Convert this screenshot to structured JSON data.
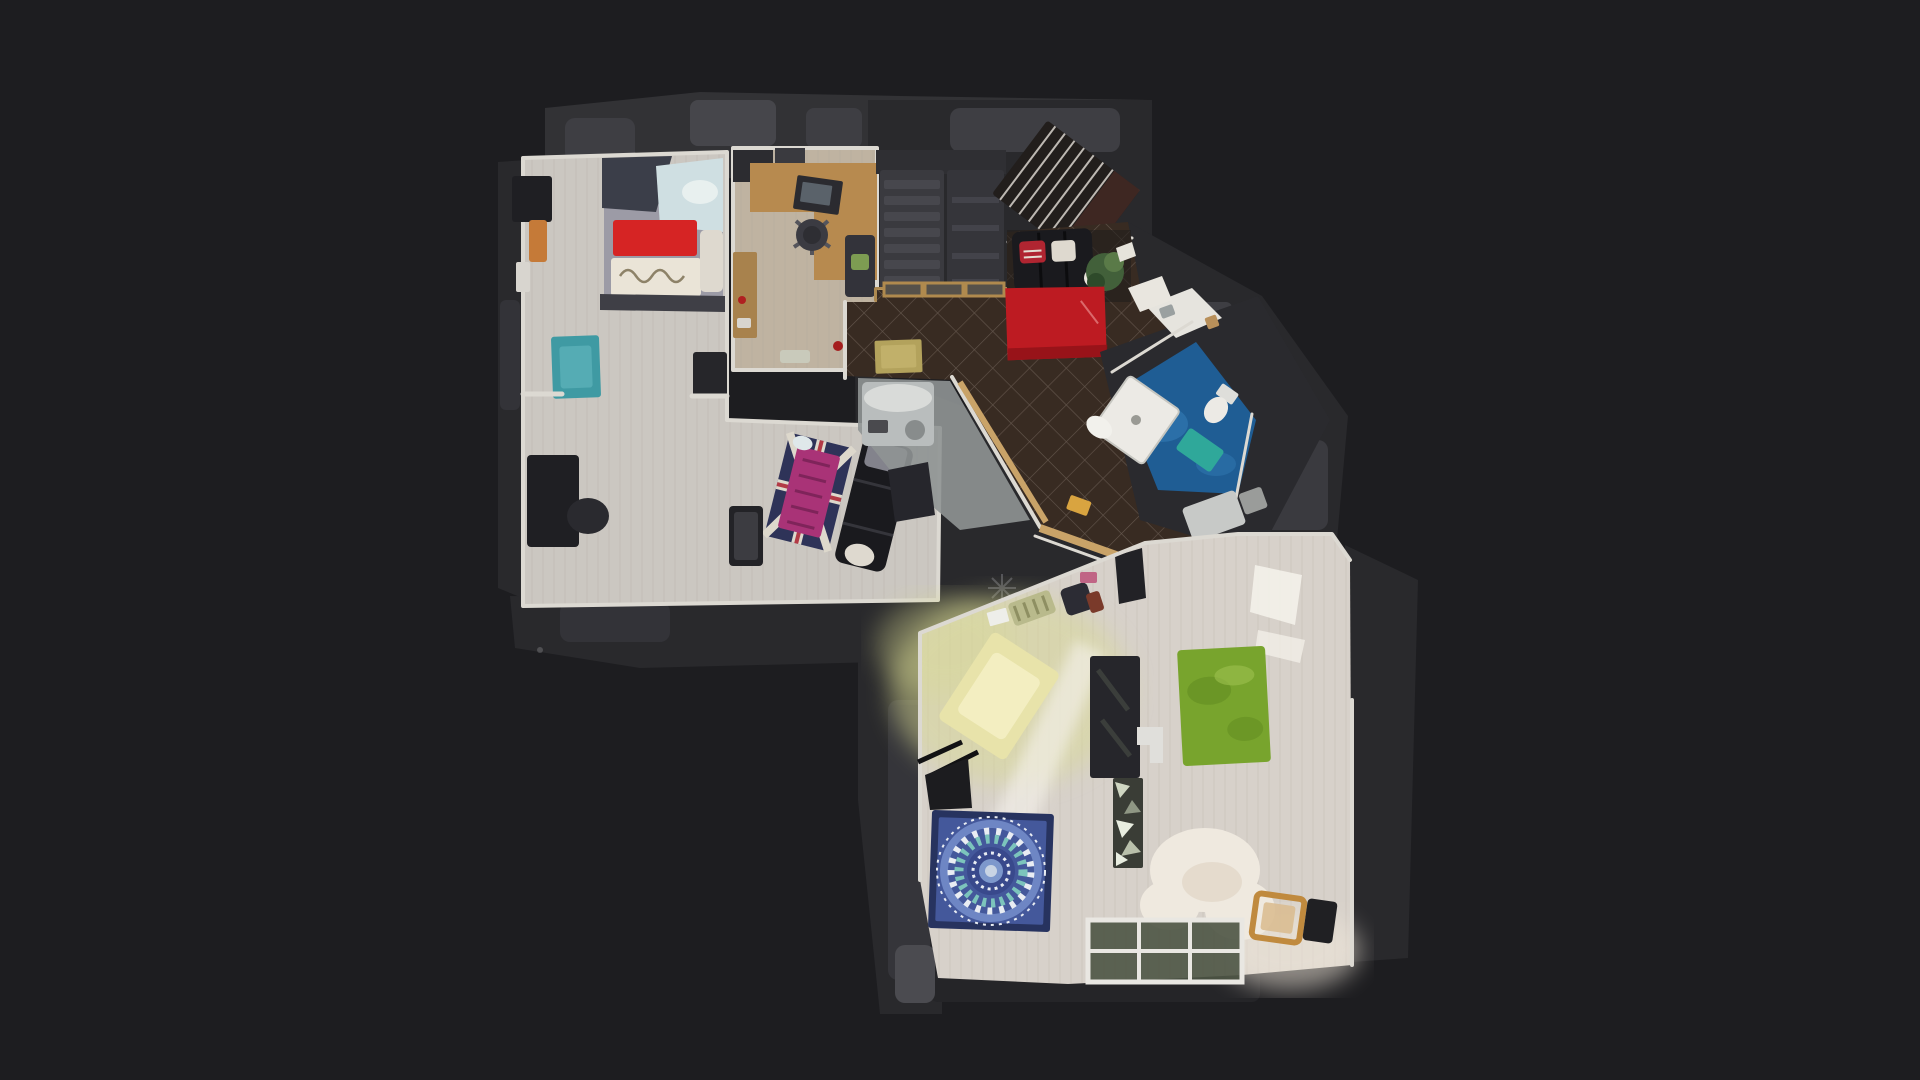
{
  "app": {
    "view": "top-down-floorplan-3d-scan",
    "description": "Dollhouse floor plan view of an apartment scan on a dark backdrop"
  },
  "canvas": {
    "background": "#1d1d20",
    "width": 1920,
    "height": 1080
  },
  "colors": {
    "fringe_dark": "#29292c",
    "fringe_mid": "#323235",
    "fringe_light": "#3e3e43",
    "wall": "#dcd9d2",
    "bedroom_floor": "#cbc7c1",
    "office_floor": "#bfb3a1",
    "living_floor": "#d7d1ca",
    "hall_tile": "#382b22",
    "hall_grout": "#8d8075",
    "machine_floor": "#8f9494",
    "bed_duvet": "#9c9ba6",
    "bed_red": "#d62424",
    "bed_quilt": "#eae4d7",
    "bed_frame": "#3b3e49",
    "pillow_blue": "#cfdfe2",
    "teal_rug": "#3f9aa3",
    "red_rug": "#bd1b22",
    "gold_mat": "#b3a25c",
    "desk_wood": "#b78a4f",
    "laptop": "#2b2b30",
    "sofa_black": "#1a1a1e",
    "pillow_red": "#b02531",
    "pillow_white": "#ded9cf",
    "futon_navy": "#2e3358",
    "futon_magenta": "#a93377",
    "stair_dark": "#3a3a3f",
    "stair_light": "#47474d",
    "step_line": "#d8d4cc",
    "bath_floor": "#1f5d94",
    "bath_mat": "#2fa89a",
    "white_fixture": "#eceae5",
    "plant_green": "#42603a",
    "yellow_rug": "#e8e3aa",
    "green_rug": "#78a42d",
    "mandala_border": "#27335f",
    "mandala_field": "#44589b",
    "mandala_teal": "#7cc4bc",
    "mandala_white": "#e9edf3",
    "tv_bench": "#26262b",
    "white_rug": "#efe9df",
    "chair_wood": "#c08a3e",
    "sun_patch": "#f4f1ea",
    "grass_tint": "#d9da93",
    "window_frame": "#e9e7e2",
    "window_pane": "#4d5444"
  },
  "rooms": [
    {
      "id": "bedroom-studio",
      "floor": "light wood"
    },
    {
      "id": "office",
      "floor": "oak wood"
    },
    {
      "id": "stair-closet-area",
      "floor": "dark"
    },
    {
      "id": "entry-hall",
      "floor": "dark diamond tile"
    },
    {
      "id": "bathroom",
      "floor": "blue"
    },
    {
      "id": "living-room",
      "floor": "light wood"
    }
  ],
  "objects": [
    "double-bed",
    "teal-rug",
    "black-desk",
    "union-jack-futon",
    "leather-sofa-upper",
    "coffee-table",
    "office-desk",
    "office-chair",
    "stair-boxes",
    "diagonal-staircase",
    "red-rug",
    "black-leather-sofa",
    "potted-plant",
    "gold-door-mat",
    "washing-machine",
    "shower-tray",
    "toilet",
    "bath-mat",
    "sink-counter",
    "yellow-shag-rug",
    "green-rug",
    "mandala-rug",
    "tv-sideboard",
    "white-side-chair",
    "mirror-mosaic-cabinet",
    "sheepskin-rug",
    "wooden-chair",
    "floor-windows"
  ]
}
